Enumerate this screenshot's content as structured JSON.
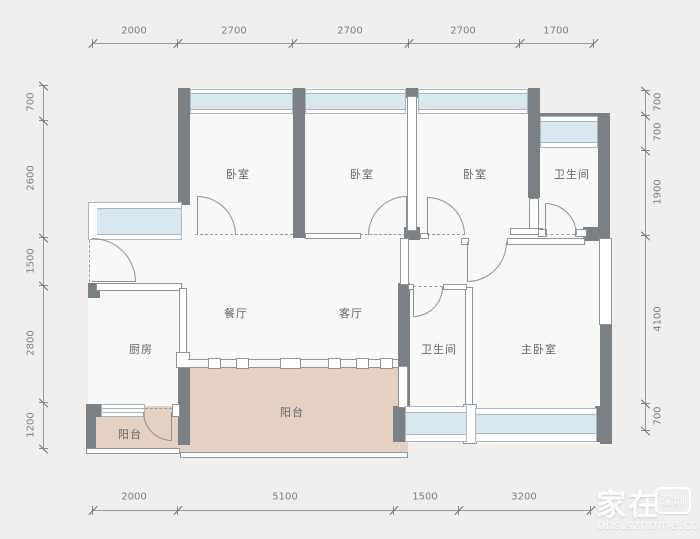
{
  "plan": {
    "rooms": [
      {
        "id": "bedroom-1",
        "label": "卧室"
      },
      {
        "id": "bedroom-2",
        "label": "卧室"
      },
      {
        "id": "bedroom-3",
        "label": "卧室"
      },
      {
        "id": "bathroom-1",
        "label": "卫生间"
      },
      {
        "id": "kitchen",
        "label": "厨房"
      },
      {
        "id": "dining-room",
        "label": "餐厅"
      },
      {
        "id": "living-room",
        "label": "客厅"
      },
      {
        "id": "bathroom-2",
        "label": "卫生间"
      },
      {
        "id": "master-bedroom",
        "label": "主卧室"
      },
      {
        "id": "balcony-main",
        "label": "阳台"
      },
      {
        "id": "balcony-small",
        "label": "阳台"
      }
    ],
    "colors": {
      "background": "#f0efee",
      "room_fill": "#f8f8f7",
      "wall": "#7b8084",
      "window_glass": "#d9e7ef",
      "balcony_fill": "#e4d1c1"
    }
  },
  "dimensions": {
    "top": [
      "2000",
      "2700",
      "2700",
      "2700",
      "1700"
    ],
    "bottom": [
      "2000",
      "5100",
      "1500",
      "3200"
    ],
    "left": [
      "700",
      "2600",
      "1500",
      "2800",
      "1200"
    ],
    "right": [
      "700",
      "700",
      "1900",
      "4100",
      "700"
    ]
  },
  "watermark": {
    "title": "家在",
    "badge": "深圳",
    "site": "bbs.szhome.com"
  }
}
